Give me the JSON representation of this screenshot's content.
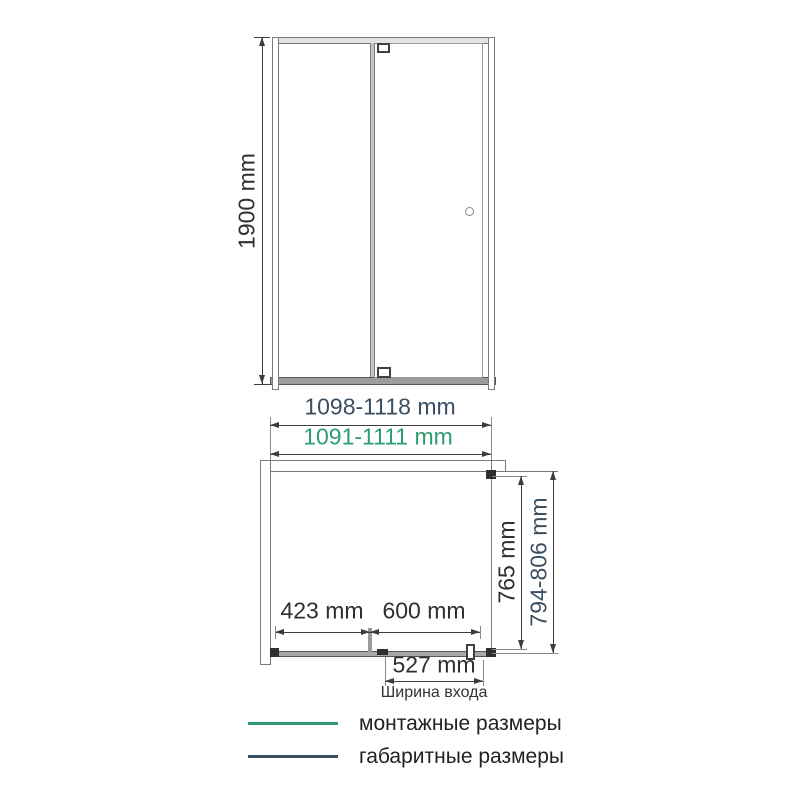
{
  "title": "Shower enclosure dimension drawing",
  "colors": {
    "mounting_green": "#2e9c70",
    "overall_navy": "#3b4f63",
    "drawing_line": "#3c3c3c"
  },
  "front_view": {
    "height_label": "1900 mm"
  },
  "width_dims": {
    "overall": "1098-1118 mm",
    "mounting": "1091-1111 mm"
  },
  "plan_view": {
    "fixed_panel": "423 mm",
    "door_width": "600 mm",
    "entrance_width": "527 mm",
    "entrance_caption": "Ширина входа",
    "inner_depth": "765 mm",
    "overall_depth": "794-806 mm"
  },
  "legend": {
    "items": [
      {
        "label": "монтажные размеры",
        "color": "#2e9c70"
      },
      {
        "label": "габаритные размеры",
        "color": "#3b4f63"
      }
    ]
  }
}
